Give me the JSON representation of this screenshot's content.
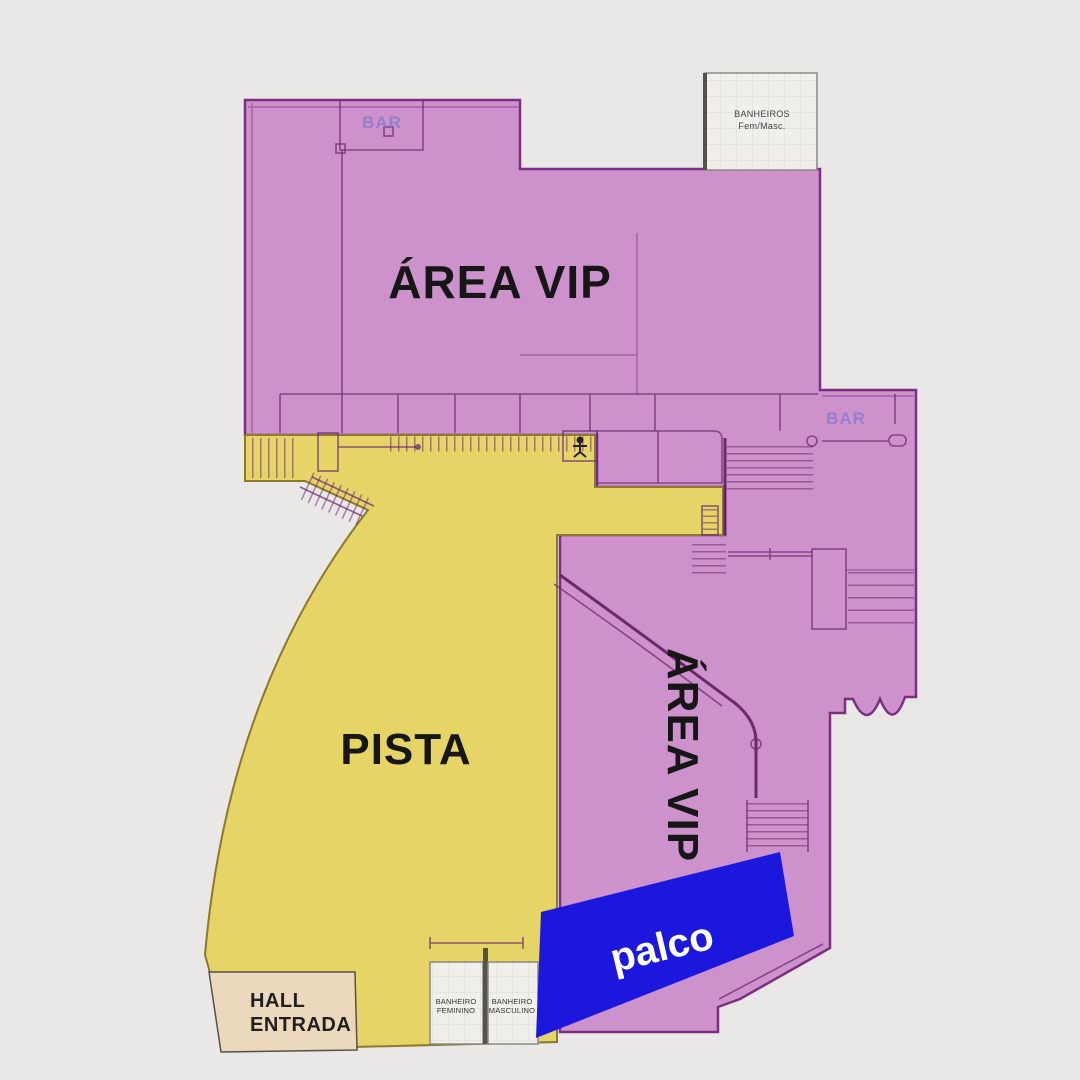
{
  "colors": {
    "background": "#e9e8e7",
    "vip_pink": "#cd92cb",
    "vip_pink_dark": "#c586c4",
    "pista_yellow": "#e6d466",
    "palco_blue": "#1c17dd",
    "hall_beige": "#ecd9bd",
    "tile_white": "#f0efeb",
    "tile_grid": "#dbd9d1",
    "bar_text": "#7a74d0",
    "label_black": "#161616",
    "label_white": "#ffffff"
  },
  "areas": {
    "vip_top": {
      "label": "ÁREA VIP"
    },
    "vip_right": {
      "label": "ÁREA VIP"
    },
    "pista": {
      "label": "PISTA"
    },
    "palco": {
      "label": "palco"
    },
    "hall_entrada": {
      "line1": "HALL",
      "line2": "ENTRADA"
    },
    "banheiros_top": {
      "line1": "BANHEIROS",
      "line2": "Fem/Masc."
    },
    "banheiro_feminino": {
      "line1": "BANHEIRO",
      "line2": "FEMININO"
    },
    "banheiro_masculino": {
      "line1": "BANHEIRO",
      "line2": "MASCULINO"
    },
    "bar_top": {
      "label": "BAR"
    },
    "bar_right": {
      "label": "BAR"
    }
  }
}
